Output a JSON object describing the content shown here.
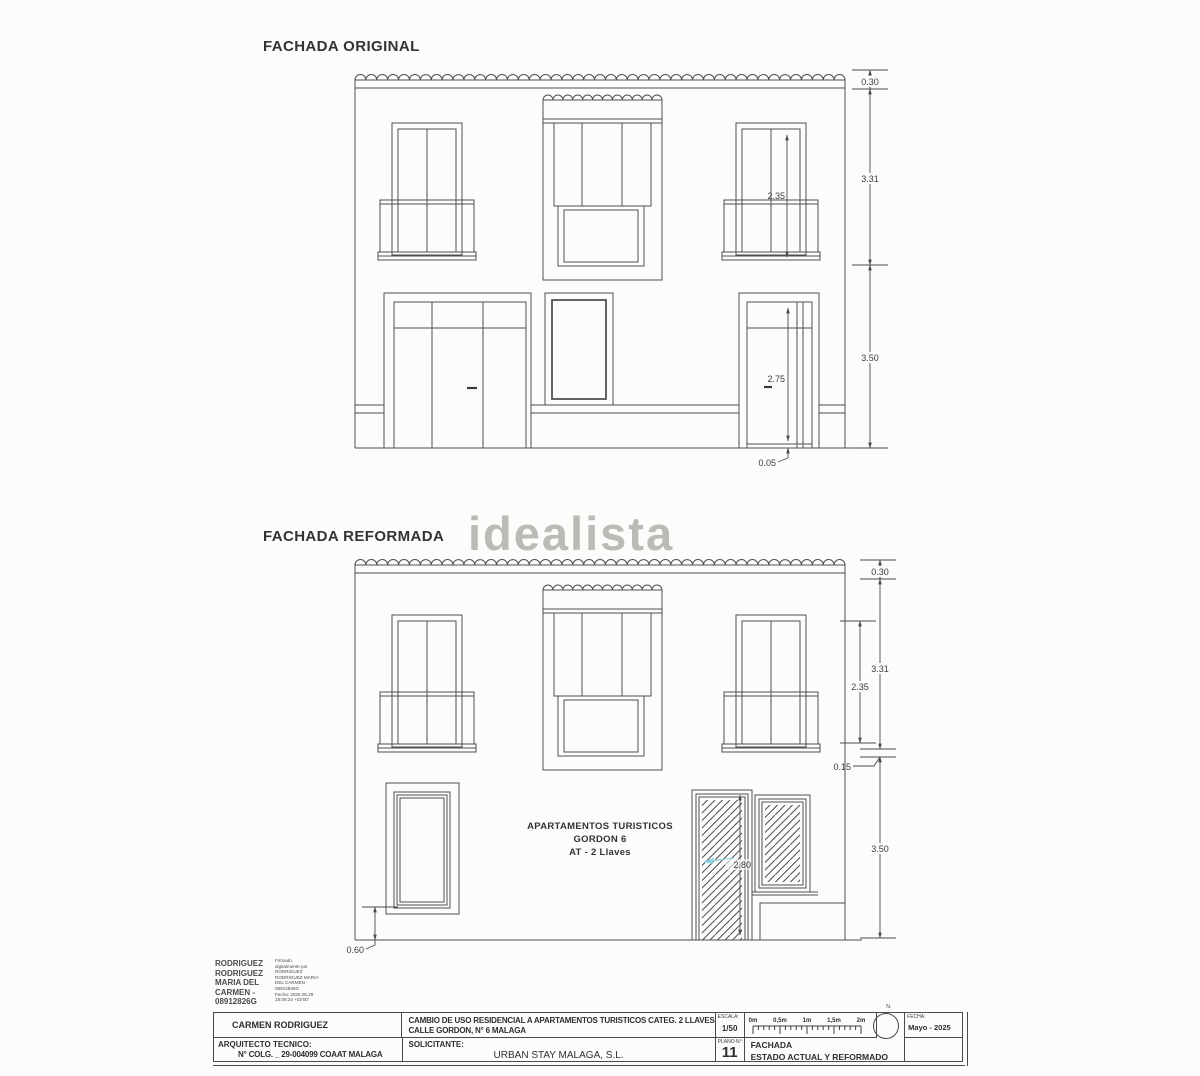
{
  "watermark": "idealista",
  "facade_original": {
    "title": "FACHADA ORIGINAL",
    "dims": {
      "cornice": "0.30",
      "upper_floor": "3.31",
      "ground_floor": "3.50",
      "balcony_window_height": "2.35",
      "door_height": "2.75",
      "threshold": "0.05"
    }
  },
  "facade_reformed": {
    "title": "FACHADA REFORMADA",
    "dims": {
      "cornice": "0.30",
      "upper_floor": "3.31",
      "balcony_window_height": "2.35",
      "band": "0.15",
      "ground_floor": "3.50",
      "door_height": "2.80",
      "window_sill": "0.60"
    },
    "use_label": {
      "line1": "APARTAMENTOS TURISTICOS",
      "line2": "GORDON 6",
      "line3": "AT - 2 Llaves"
    }
  },
  "signature": {
    "name_lines": [
      "RODRIGUEZ",
      "RODRIGUEZ",
      "MARIA DEL",
      "CARMEN -",
      "08912826G"
    ],
    "detail_lines": [
      "Firmado",
      "digitalmente por",
      "RODRIGUEZ",
      "RODRIGUEZ MARIA",
      "DEL CARMEN -",
      "08912826G",
      "Fecha: 2025.05.29",
      "18:09:24 +02'00'"
    ]
  },
  "title_block": {
    "author": "CARMEN RODRIGUEZ",
    "project_line1": "CAMBIO DE USO RESIDENCIAL A APARTAMENTOS TURISTICOS CATEG. 2 LLAVES",
    "project_line2": "CALLE GORDON, N° 6  MALAGA",
    "role_label": "ARQUITECTO TECNICO:",
    "role_value": "N° COLG. _ 29-004099  COAAT MALAGA",
    "applicant_label": "SOLICITANTE:",
    "applicant_value": "URBAN STAY MALAGA, S.L.",
    "scale_label": "ESCALA:",
    "scale_value": "1/50",
    "scale_ticks": [
      "0m",
      "0,5m",
      "1m",
      "1,5m",
      "2m"
    ],
    "north_label": "N.",
    "date_label": "FECHA:",
    "date_value": "Mayo - 2025",
    "plan_label": "PLANO N°:",
    "plan_number": "11",
    "sheet_title_line1": "FACHADA",
    "sheet_title_line2": "ESTADO ACTUAL Y REFORMADO"
  }
}
